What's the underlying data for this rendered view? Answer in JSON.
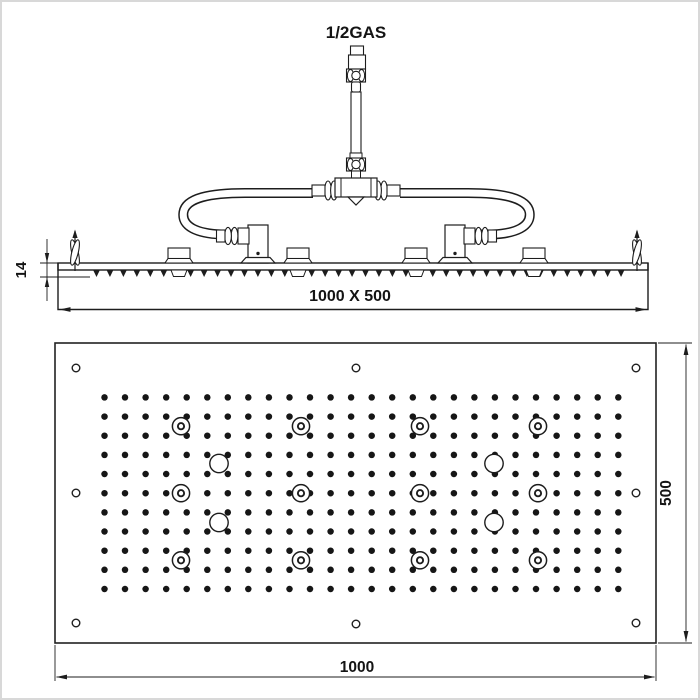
{
  "page": {
    "title": "Ceiling shower head technical drawing",
    "background_color": "#ffffff",
    "frame_color": "#d8d8d8",
    "line_color": "#1d1d1d"
  },
  "side_view": {
    "name": "Side elevation with water connection",
    "connection_label": "1/2GAS",
    "thickness_dimension": "14",
    "panel_dimension": "1000 X 500",
    "flexible_hoses": 2,
    "mounting_brackets": 2,
    "support_blocks": 4,
    "spring_clips": 2,
    "nozzle_teeth": 40
  },
  "plan_view": {
    "name": "Spray face bottom view",
    "width_dimension": "1000",
    "height_dimension": "500",
    "mounting_holes": 8,
    "nozzle_grid": {
      "columns": 26,
      "rows": 11
    },
    "led_spots": {
      "count": 12,
      "columns": 4,
      "rows": 3
    },
    "round_outlets": 4
  }
}
